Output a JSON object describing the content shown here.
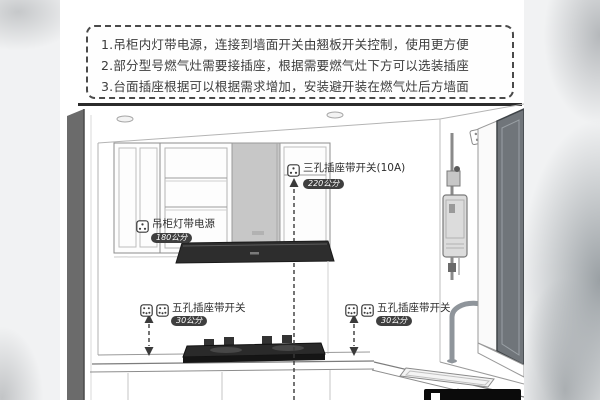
{
  "notes": {
    "lines": [
      "1.吊柜内灯带电源，连接到墙面开关由翘板开关控制，使用更方便",
      "2.部分型号燃气灶需要接插座，根据需要燃气灶下方可以选装插座",
      "3.台面插座根据可以根据需求增加，安装避开装在燃气灶后方墙面"
    ]
  },
  "annotations": {
    "cabinet_light": {
      "label": "吊柜灯带电源",
      "height": "180公分"
    },
    "three_hole": {
      "label": "三孔插座带开关(10A)",
      "height": "220公分"
    },
    "five_hole_left": {
      "label": "五孔插座带开关",
      "height": "30公分"
    },
    "five_hole_right": {
      "label": "五孔插座带开关",
      "height": "30公分"
    }
  },
  "colors": {
    "badge_bg": "#3f3f3f",
    "line_dark": "#2b2b2b",
    "duct_gray": "#c7c7c7",
    "hood_black": "#2d2d2d"
  }
}
